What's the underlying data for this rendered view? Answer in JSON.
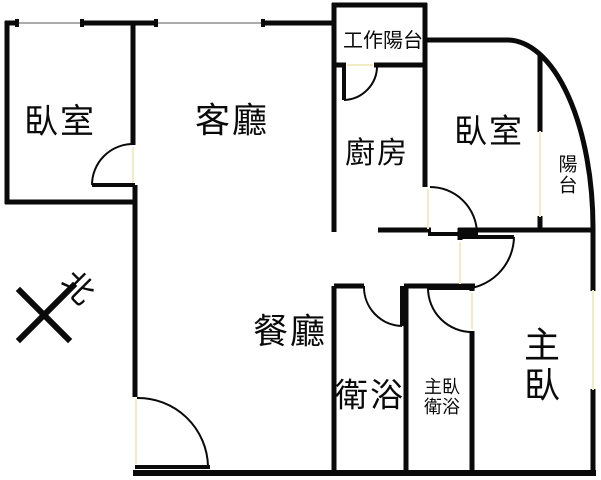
{
  "colors": {
    "wall": "#0a0a0a",
    "door_opening": "#f2ecc4",
    "window_line": "#8f8f8f",
    "background": "#ffffff"
  },
  "rooms": {
    "bedroom_left": {
      "label": "臥室"
    },
    "living_room": {
      "label": "客廳"
    },
    "work_balcony": {
      "label": "工作陽台"
    },
    "kitchen": {
      "label": "廚房"
    },
    "bedroom_right": {
      "label": "臥室"
    },
    "balcony": {
      "label": "陽台"
    },
    "dining_room": {
      "label": "餐廳"
    },
    "bathroom": {
      "label": "衛浴"
    },
    "master_bathroom": {
      "label": "主臥\n衛浴"
    },
    "master_bedroom": {
      "label": "主臥"
    }
  },
  "compass": {
    "north": "北"
  }
}
